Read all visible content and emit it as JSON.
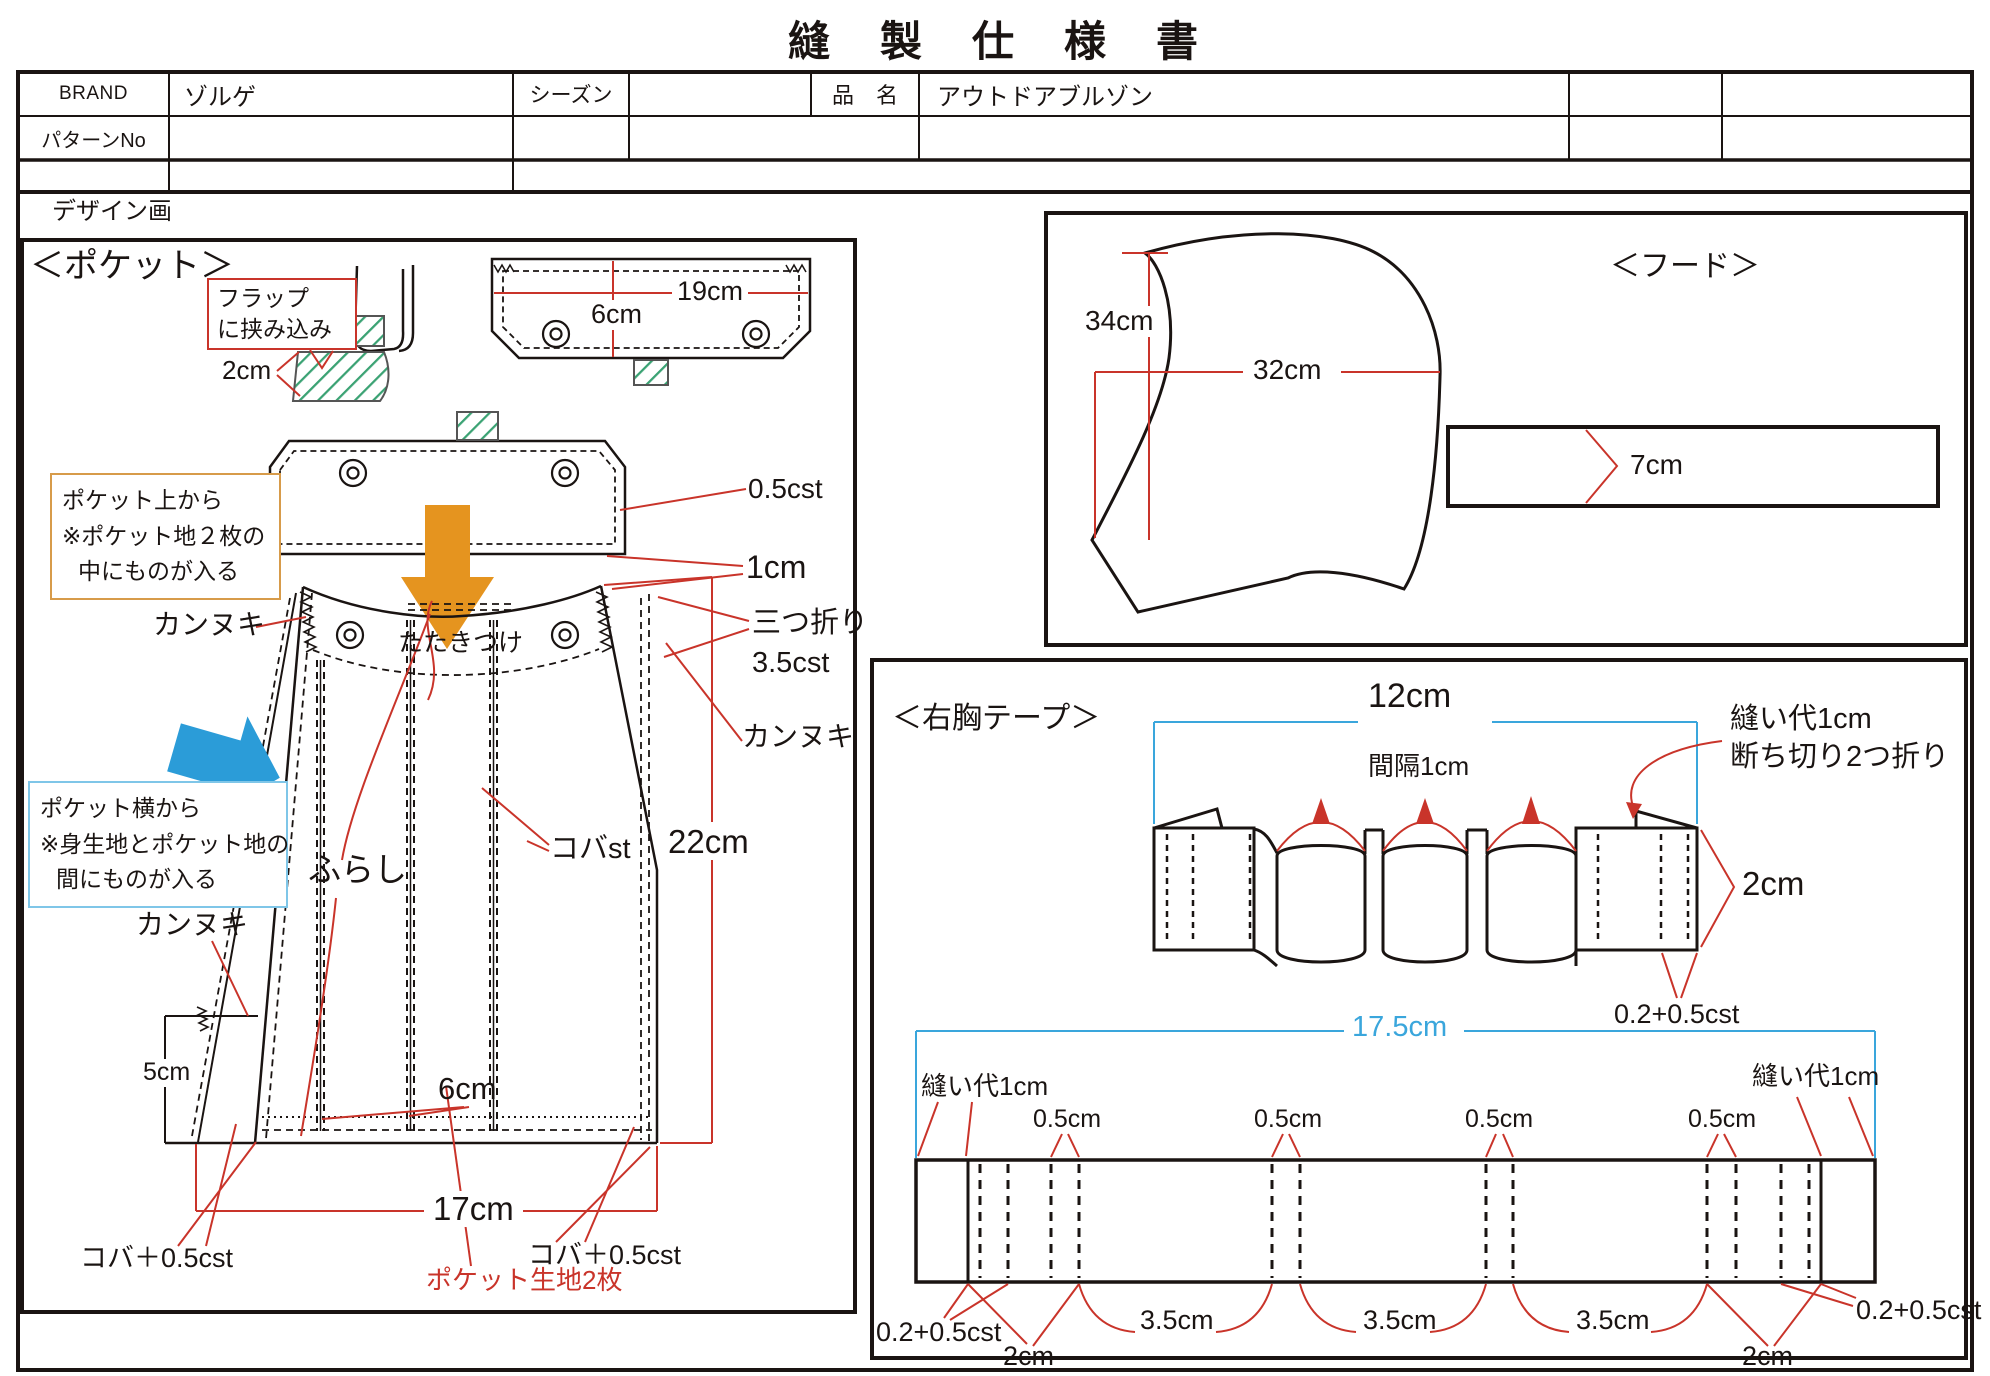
{
  "title": "縫　製　仕　様　書",
  "header": {
    "brand_label": "BRAND",
    "brand_value": "ゾルゲ",
    "season_label": "シーズン",
    "item_label": "品　名",
    "item_value": "アウトドアブルゾン",
    "pattern_no_label": "パターンNo",
    "design_label": "デザイン画"
  },
  "pocket": {
    "heading": "＜ポケット＞",
    "flap_note": [
      "フラップ",
      "に挟み込み"
    ],
    "top_note": [
      "ポケット上から",
      "※ポケット地２枚の",
      "中にものが入る"
    ],
    "side_note": [
      "ポケット横から",
      "※身生地とポケット地の",
      "間にものが入る"
    ],
    "dim_2cm": "2cm",
    "dim_19cm": "19cm",
    "dim_6cm_flap": "6cm",
    "st_05cst": "0.5cst",
    "dim_1cm": "1cm",
    "mitsuori": "三つ折り",
    "st_35cst": "3.5cst",
    "kannuki": "カンヌキ",
    "tatakitsuke": "たたきつけ",
    "furashi": "ふらし",
    "koba_st": "コバst",
    "dim_22cm": "22cm",
    "dim_5cm": "5cm",
    "dim_6cm": "6cm",
    "dim_17cm": "17cm",
    "koba_05cst": "コバ＋0.5cst",
    "fabric_note": "ポケット生地2枚"
  },
  "hood": {
    "heading": "＜フード＞",
    "dim_34cm": "34cm",
    "dim_32cm": "32cm",
    "dim_7cm": "7cm"
  },
  "tape": {
    "heading": "＜右胸テープ＞",
    "dim_12cm": "12cm",
    "spacing_note": "間隔1cm",
    "seam_note": [
      "縫い代1cm",
      "断ち切り2つ折り"
    ],
    "dim_2cm": "2cm",
    "st_0205": "0.2+0.5cst",
    "dim_175cm": "17.5cm",
    "seam_allowance": "縫い代1cm",
    "dim_05cm": "0.5cm",
    "dim_35cm": "3.5cm"
  },
  "colors": {
    "ink": "#1a1412",
    "red": "#c9342a",
    "blue": "#3aa6dc",
    "green_hatch": "#3aa273",
    "orange_arrow": "#e5941f",
    "blue_arrow": "#2b9cd8",
    "box_orange": "#d79b4a",
    "box_blue": "#7fc6e8"
  }
}
